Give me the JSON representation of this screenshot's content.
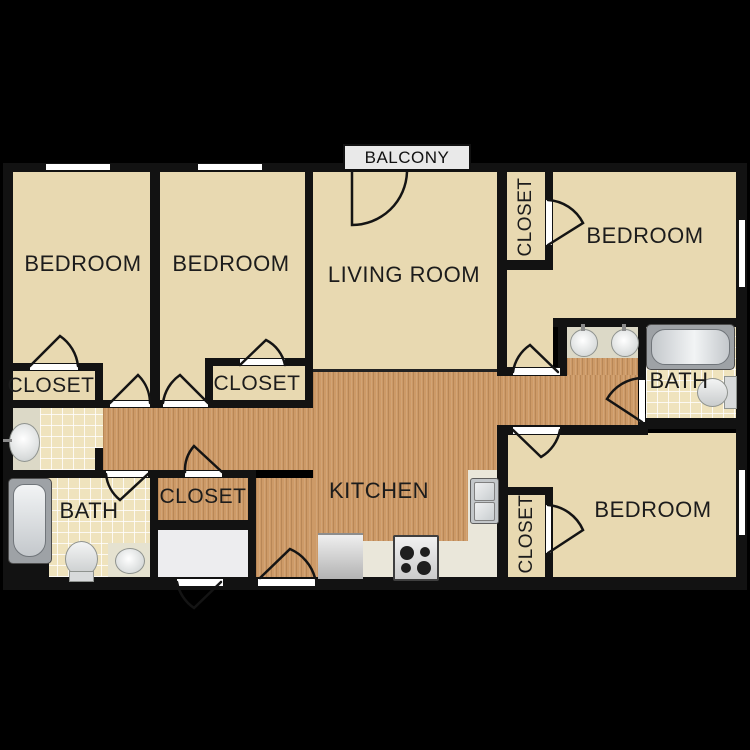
{
  "plan": {
    "balcony_label": "BALCONY",
    "labels": {
      "bedroom_top_left": "BEDROOM",
      "bedroom_top_middle": "BEDROOM",
      "bedroom_top_right": "BEDROOM",
      "bedroom_bottom_right": "BEDROOM",
      "living_room": "LIVING ROOM",
      "kitchen": "KITCHEN",
      "bath_left": "BATH",
      "bath_right": "BATH",
      "closet_top_left": "CLOSET",
      "closet_bedroom2": "CLOSET",
      "closet_top_right": "CLOSET",
      "closet_hall": "CLOSET",
      "closet_bottom_right": "CLOSET"
    },
    "colors": {
      "background": "#000000",
      "wall": "#121212",
      "room_floor": "#e8d9b1",
      "wood_floor": "#cd9a67",
      "tile_floor": "#efe3bd",
      "counter": "#dcd9c7",
      "kitchen_counter": "#eae7da",
      "window": "#ffffff",
      "label_text": "#1c1c1c",
      "balcony_box": "#e9e9e9"
    }
  }
}
